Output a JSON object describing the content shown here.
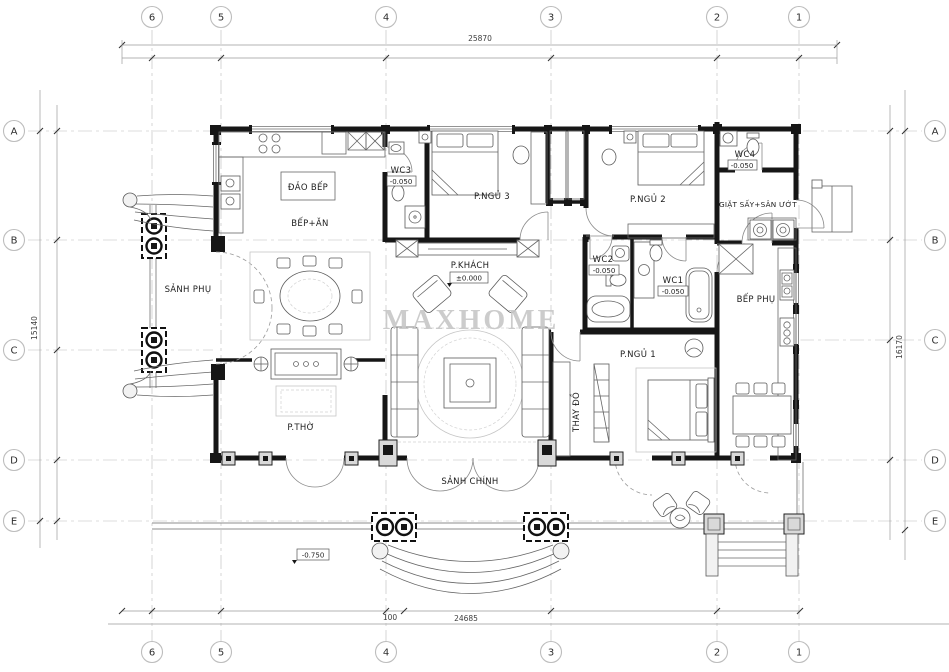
{
  "watermark": "MAXHOME",
  "grid": {
    "cols": [
      "6",
      "5",
      "4",
      "3",
      "2",
      "1"
    ],
    "rows": [
      "A",
      "B",
      "C",
      "D",
      "E"
    ]
  },
  "dimensions": {
    "top": "25870",
    "left": "15140",
    "right": "16170",
    "bottom": "24685",
    "bottom_inner": "100"
  },
  "rooms": {
    "island": "ĐẢO BẾP",
    "kitchen": "BẾP+ĂN",
    "wc3": "WC3",
    "bed3": "P.NGỦ 3",
    "bed2": "P.NGỦ 2",
    "wc4": "WC4",
    "laundry": "GIẶT SẤY+SÂN ƯỚT",
    "side_hall": "SẢNH PHỤ",
    "living": "P.KHÁCH",
    "wc2": "WC2",
    "wc1": "WC1",
    "kitchen2": "BẾP PHỤ",
    "worship": "P.THỜ",
    "closet": "THAY ĐỒ",
    "bed1": "P.NGỦ 1",
    "main_hall": "SẢNH CHÍNH"
  },
  "levels": {
    "living": "±0.000",
    "wc1": "-0.050",
    "wc2": "-0.050",
    "wc3": "-0.050",
    "wc4": "-0.050",
    "porch": "-0.750"
  }
}
